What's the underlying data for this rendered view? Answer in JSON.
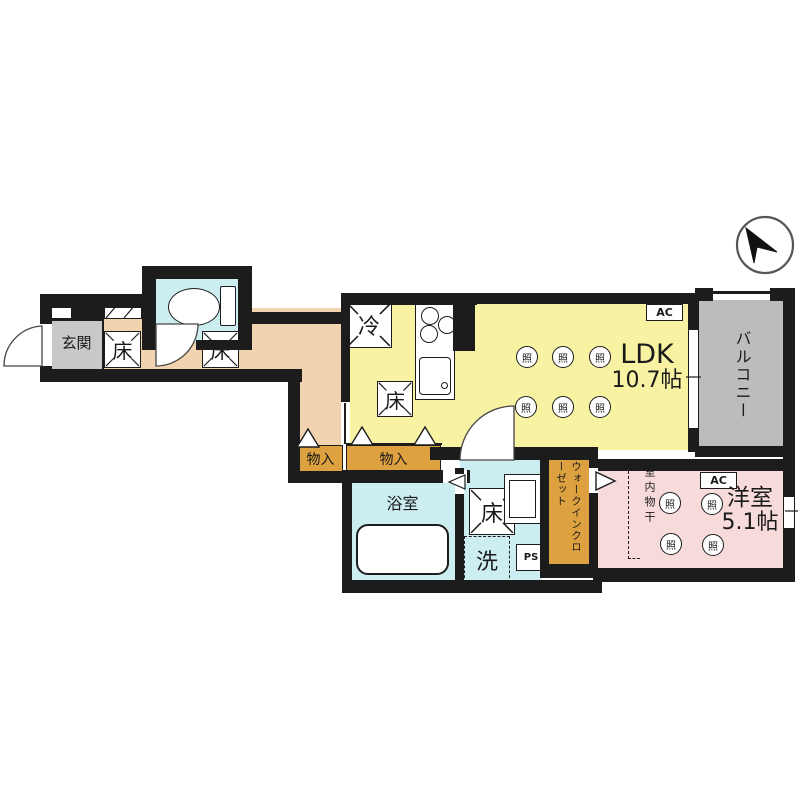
{
  "labels": {
    "genkan": "玄関",
    "floor_hatch": "床",
    "storage": "物入",
    "bathroom": "浴室",
    "washer": "洗",
    "fridge": "冷",
    "light": "照",
    "ldk_line1": "LDK",
    "ldk_line2": "10.7帖",
    "balcony": "バルコニー",
    "wic": "ウォークインクローゼット",
    "indoor_drying": "室内物干",
    "youshitsu_line1": "洋室",
    "youshitsu_line2": "5.1帖",
    "ac": "AC",
    "ps": "PS"
  },
  "colors": {
    "hallway_peach": "#f2d3b0",
    "genkan_gray": "#c8c8c8",
    "wet_room_cyan": "#cdeef0",
    "ldk_yellow": "#f8f3a3",
    "closet_orange": "#dda13f",
    "bedroom_pink": "#f7dbdb",
    "balcony_gray": "#bcbcbc",
    "wall_black": "#1c1c1c"
  }
}
